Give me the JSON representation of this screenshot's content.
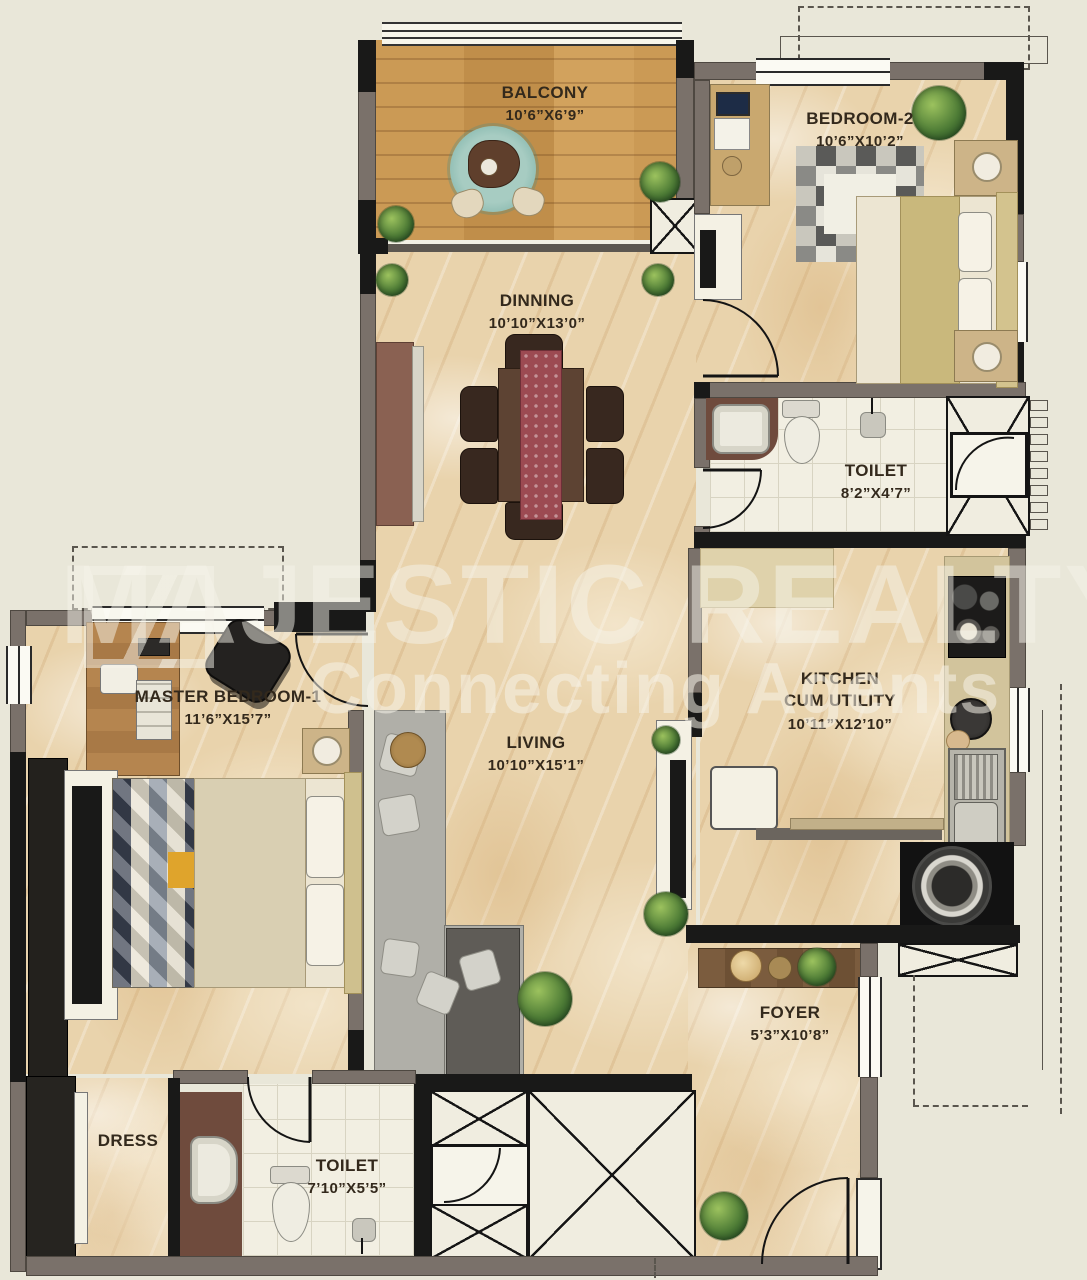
{
  "plan_title": "2 BHK apartment floor plan",
  "watermark": {
    "line1": "MAJESTIC REALTY",
    "line2": "Connecting Agents"
  },
  "rooms": [
    {
      "id": "balcony",
      "name": "BALCONY",
      "dims": "10’6”X6’9”"
    },
    {
      "id": "bedroom-2",
      "name": "BEDROOM-2",
      "dims": "10’6”X10’2”"
    },
    {
      "id": "dinning",
      "name": "DINNING",
      "dims": "10’10”X13’0”"
    },
    {
      "id": "toilet-top",
      "name": "TOILET",
      "dims": "8’2”X4’7”"
    },
    {
      "id": "master-bedroom",
      "name": "MASTER BEDROOM-1",
      "dims": "11’6”X15’7”"
    },
    {
      "id": "kitchen",
      "name": "KITCHEN",
      "name2": "CUM UTILITY",
      "dims": "10’11”X12’10”"
    },
    {
      "id": "living",
      "name": "LIVING",
      "dims": "10’10”X15’1”"
    },
    {
      "id": "foyer",
      "name": "FOYER",
      "dims": "5’3”X10’8”"
    },
    {
      "id": "dress",
      "name": "DRESS"
    },
    {
      "id": "toilet-bottom",
      "name": "TOILET",
      "dims": "7’10”X5’5”"
    }
  ],
  "colors": {
    "background": "#e9e7d9",
    "wall": "#7a716a",
    "wall_dark": "#191918",
    "marble_floor": "#e9d3ac",
    "wood_floor": "#c99a55",
    "tile_floor": "#f2efe2",
    "rug_teal": "#8fbdb3",
    "runner_maroon": "#9c4a52",
    "rug_accent_yellow": "#dfa42c",
    "watermark": "#f5f3ea"
  }
}
